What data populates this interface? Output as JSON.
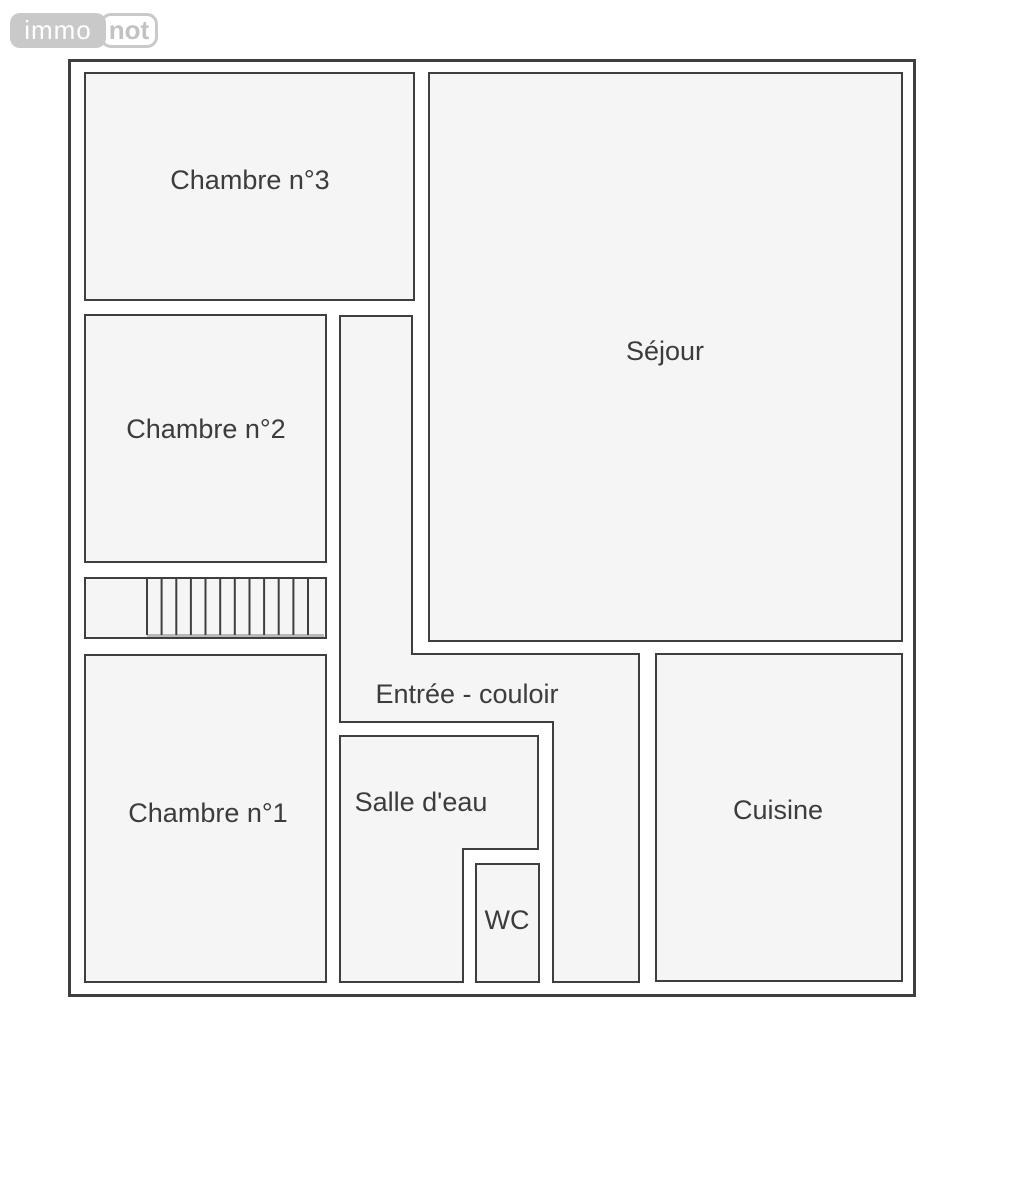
{
  "logo": {
    "immo": "immo",
    "not": "not"
  },
  "floorplan": {
    "rooms": {
      "chambre3": {
        "label": "Chambre n°3"
      },
      "sejour": {
        "label": "Séjour"
      },
      "chambre2": {
        "label": "Chambre n°2"
      },
      "chambre1": {
        "label": "Chambre n°1"
      },
      "couloir": {
        "label": "Entrée - couloir"
      },
      "salle_eau": {
        "label": "Salle d'eau"
      },
      "wc": {
        "label": "WC"
      },
      "cuisine": {
        "label": "Cuisine"
      }
    },
    "stairs": {
      "description": "staircase with treads",
      "tread_count": 12
    }
  },
  "colors": {
    "background": "#ffffff",
    "wall": "#3f3f3f",
    "room_fill": "#f5f5f5",
    "label_text": "#3c3c3c",
    "logo_gray": "#c9c9c9",
    "logo_text_left": "#ffffff",
    "logo_text_right": "#c2c2c2"
  }
}
